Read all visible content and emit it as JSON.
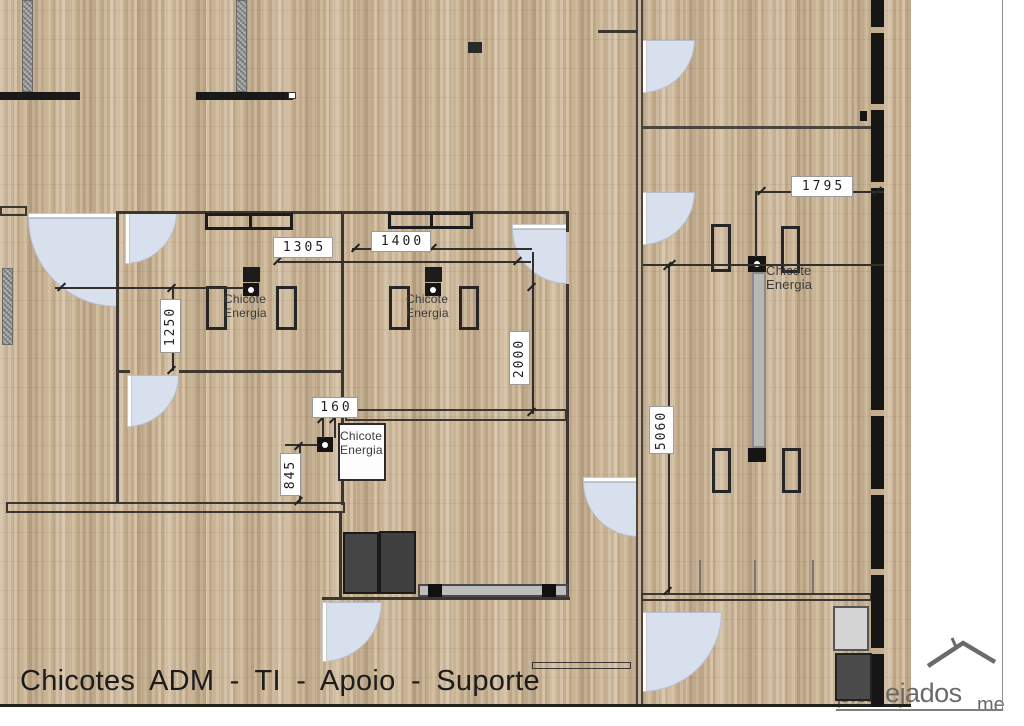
{
  "title": {
    "text": "Chicotes  ADM - TI - Apoio - Suporte"
  },
  "watermark": {
    "text": "planejados",
    "suffix": "me"
  },
  "colors": {
    "floor_base": "#c7b093",
    "wall": "#3b362f",
    "wall_black": "#161616",
    "door_fill": "#d9e0ed",
    "column_gray": "#9c9c9c",
    "dim_text": "#1f1f1f",
    "counter_gray": "#bdbdbd",
    "watermark_gray": "#6a6a6a"
  },
  "plan": {
    "columns": [
      {
        "x": 22,
        "y": 0,
        "w": 11,
        "h": 92
      },
      {
        "x": 236,
        "y": 0,
        "w": 11,
        "h": 92
      },
      {
        "x": 2,
        "y": 268,
        "w": 11,
        "h": 77
      }
    ],
    "doors": [
      {
        "x": 28,
        "y": 218,
        "r": 89,
        "corner": "tr",
        "leaf": "top",
        "n": "door-hall"
      },
      {
        "x": 125,
        "y": 212,
        "r": 52,
        "corner": "tl",
        "leaf": "left",
        "n": "door-room1"
      },
      {
        "x": 127,
        "y": 375,
        "r": 52,
        "corner": "tl",
        "leaf": "left",
        "n": "door-room1-south"
      },
      {
        "x": 512,
        "y": 229,
        "r": 55,
        "corner": "tr",
        "leaf": "top",
        "n": "door-room2"
      },
      {
        "x": 583,
        "y": 482,
        "r": 55,
        "corner": "tr",
        "leaf": "top",
        "n": "door-corridor"
      },
      {
        "x": 642,
        "y": 40,
        "r": 53,
        "corner": "tl",
        "leaf": "left",
        "n": "door-right-top"
      },
      {
        "x": 642,
        "y": 192,
        "r": 53,
        "corner": "tl",
        "leaf": "left",
        "n": "door-right-mid"
      },
      {
        "x": 642,
        "y": 612,
        "r": 80,
        "corner": "tl",
        "leaf": "left",
        "n": "door-right-low"
      },
      {
        "x": 322,
        "y": 602,
        "r": 60,
        "corner": "tl",
        "leaf": "left",
        "n": "door-storage"
      }
    ],
    "walls": [
      {
        "x": 0,
        "y": 92,
        "w": 80,
        "h": 8,
        "c": "#191919",
        "n": "wall-bar-top-left"
      },
      {
        "x": 196,
        "y": 92,
        "w": 97,
        "h": 8,
        "c": "#191919",
        "n": "wall-bar-top-mid"
      },
      {
        "x": 117,
        "y": 211,
        "w": 450,
        "h": 3,
        "n": "wall-rooms-top"
      },
      {
        "x": 116,
        "y": 211,
        "w": 3,
        "h": 292,
        "n": "wall-room1-left"
      },
      {
        "x": 341,
        "y": 211,
        "w": 3,
        "h": 294,
        "n": "wall-room-divider"
      },
      {
        "x": 566,
        "y": 211,
        "w": 3,
        "h": 21,
        "n": "wall-room2-right-a"
      },
      {
        "x": 566,
        "y": 284,
        "w": 3,
        "h": 316,
        "n": "wall-room2-right-b"
      },
      {
        "x": 116,
        "y": 370,
        "w": 14,
        "h": 3,
        "n": "wall-room1-bottom-a"
      },
      {
        "x": 179,
        "y": 370,
        "w": 164,
        "h": 3,
        "n": "wall-room1-bottom-b"
      },
      {
        "x": 339,
        "y": 513,
        "w": 3,
        "h": 87,
        "n": "wall-storage-left"
      },
      {
        "x": 322,
        "y": 597,
        "w": 248,
        "h": 3,
        "n": "wall-storage-bottom"
      },
      {
        "x": 636,
        "y": 0,
        "w": 2,
        "h": 707,
        "c": "#4a453e",
        "n": "wall-divider-line-a"
      },
      {
        "x": 641,
        "y": 0,
        "w": 2,
        "h": 707,
        "c": "#4a453e",
        "n": "wall-divider-line-b"
      },
      {
        "x": 598,
        "y": 30,
        "w": 40,
        "h": 3,
        "n": "wall-top-stub"
      },
      {
        "x": 641,
        "y": 126,
        "w": 231,
        "h": 3,
        "c": "#4a453e",
        "n": "wall-right-corridor"
      },
      {
        "x": 699,
        "y": 560,
        "w": 2,
        "h": 34,
        "c": "#777777",
        "n": "window-mullion"
      },
      {
        "x": 754,
        "y": 560,
        "w": 2,
        "h": 34,
        "c": "#777777",
        "n": "window-mullion"
      },
      {
        "x": 812,
        "y": 560,
        "w": 2,
        "h": 34,
        "c": "#777777",
        "n": "window-mullion"
      },
      {
        "x": 0,
        "y": 704,
        "w": 911,
        "h": 3,
        "c": "#23201c",
        "n": "floor-bottom-edge"
      },
      {
        "x": 1002,
        "y": 0,
        "w": 1,
        "h": 711,
        "c": "#8f8f8f",
        "n": "page-border-right"
      },
      {
        "x": 836,
        "y": 709,
        "w": 167,
        "h": 2,
        "c": "#7d7d7d",
        "n": "watermark-underline"
      }
    ],
    "outlines": [
      {
        "x": 0,
        "y": 206,
        "w": 27,
        "h": 10,
        "b": 2,
        "n": "wall-stub-left"
      },
      {
        "x": 345,
        "y": 409,
        "w": 222,
        "h": 12,
        "b": 2,
        "n": "wall-mid-double"
      },
      {
        "x": 6,
        "y": 502,
        "w": 339,
        "h": 11,
        "b": 2,
        "n": "wall-left-double"
      },
      {
        "x": 641,
        "y": 593,
        "w": 231,
        "h": 8,
        "b": 2,
        "n": "wall-right-bottom"
      },
      {
        "x": 532,
        "y": 662,
        "w": 99,
        "h": 7,
        "b": 1.5,
        "n": "counter-low"
      },
      {
        "x": 288,
        "y": 92,
        "w": 8,
        "h": 7,
        "b": 1,
        "bg": "#ffffff",
        "n": "wall-cap"
      }
    ],
    "black_wall": {
      "x": 871,
      "y": 0,
      "w": 13,
      "h": 707,
      "gaps": [
        27,
        104,
        182,
        410,
        489,
        569,
        648
      ]
    },
    "desks": [
      {
        "x": 206,
        "y": 286,
        "w": 21,
        "h": 44
      },
      {
        "x": 276,
        "y": 286,
        "w": 21,
        "h": 44
      },
      {
        "x": 389,
        "y": 286,
        "w": 21,
        "h": 44
      },
      {
        "x": 459,
        "y": 286,
        "w": 20,
        "h": 44
      },
      {
        "x": 711,
        "y": 224,
        "w": 20,
        "h": 48
      },
      {
        "x": 781,
        "y": 226,
        "w": 19,
        "h": 47
      },
      {
        "x": 712,
        "y": 448,
        "w": 19,
        "h": 45
      },
      {
        "x": 782,
        "y": 448,
        "w": 19,
        "h": 45
      }
    ],
    "cabinets": [
      {
        "x": 205,
        "y": 213,
        "w": 88,
        "h": 17,
        "div": 44
      },
      {
        "x": 388,
        "y": 212,
        "w": 85,
        "h": 17,
        "div": 42
      }
    ],
    "boxes": [
      {
        "x": 343,
        "y": 532,
        "w": 36,
        "h": 62,
        "bg": "#454545",
        "bd": "#1a1a1a",
        "n": "wardrobe"
      },
      {
        "x": 379,
        "y": 531,
        "w": 37,
        "h": 63,
        "bg": "#404040",
        "bd": "#1a1a1a",
        "n": "wardrobe"
      },
      {
        "x": 418,
        "y": 584,
        "w": 150,
        "h": 13,
        "bg": "#bdbdbd",
        "bd": "#4a4a4a",
        "n": "counter"
      },
      {
        "x": 428,
        "y": 584,
        "w": 14,
        "h": 13,
        "bg": "#111111",
        "bd": "#111111",
        "n": "counter-outlet"
      },
      {
        "x": 542,
        "y": 584,
        "w": 14,
        "h": 13,
        "bg": "#111111",
        "bd": "#111111",
        "n": "counter-outlet"
      },
      {
        "x": 752,
        "y": 272,
        "w": 14,
        "h": 176,
        "bg": "#b7b7b7",
        "bd": "#8a8a8a",
        "n": "cable-tray"
      },
      {
        "x": 748,
        "y": 448,
        "w": 18,
        "h": 14,
        "bg": "#151515",
        "bd": "#151515",
        "n": "tray-endcap"
      },
      {
        "x": 833,
        "y": 606,
        "w": 36,
        "h": 45,
        "bg": "#d4d4d4",
        "bd": "#555555",
        "n": "appliance"
      },
      {
        "x": 835,
        "y": 653,
        "w": 37,
        "h": 48,
        "bg": "#4b4b4b",
        "bd": "#222222",
        "n": "cabinet-dark"
      },
      {
        "x": 468,
        "y": 42,
        "w": 14,
        "h": 11,
        "bg": "#2a2a2a",
        "bd": "#2a2a2a",
        "n": "floor-marker"
      },
      {
        "x": 860,
        "y": 111,
        "w": 7,
        "h": 10,
        "bg": "#141414",
        "bd": "#141414",
        "n": "wall-marker"
      },
      {
        "x": 243,
        "y": 267,
        "w": 17,
        "h": 15,
        "bg": "#1c1c1c",
        "bd": "#1c1c1c",
        "n": "junction-box"
      },
      {
        "x": 425,
        "y": 267,
        "w": 17,
        "h": 15,
        "bg": "#1c1c1c",
        "bd": "#1c1c1c",
        "n": "junction-box"
      },
      {
        "x": 338,
        "y": 423,
        "w": 48,
        "h": 58,
        "bg": "#fdfdfd",
        "bd": "#2b2b2b",
        "n": "power-cabinet"
      }
    ],
    "outlets": [
      {
        "x": 243,
        "y": 283,
        "w": 16,
        "h": 13
      },
      {
        "x": 425,
        "y": 283,
        "w": 16,
        "h": 13
      },
      {
        "x": 317,
        "y": 437,
        "w": 16,
        "h": 15
      },
      {
        "x": 748,
        "y": 256,
        "w": 18,
        "h": 16
      }
    ],
    "dim_lines": [
      {
        "x": 278,
        "y": 261,
        "len": 253,
        "o": "h"
      },
      {
        "x": 352,
        "y": 248,
        "len": 180,
        "o": "h"
      },
      {
        "x": 55,
        "y": 287,
        "len": 189,
        "o": "h"
      },
      {
        "x": 172,
        "y": 287,
        "len": 84,
        "o": "v"
      },
      {
        "x": 532,
        "y": 252,
        "len": 162,
        "o": "v"
      },
      {
        "x": 299,
        "y": 444,
        "len": 59,
        "o": "v"
      },
      {
        "x": 285,
        "y": 444,
        "len": 33,
        "o": "h"
      },
      {
        "x": 668,
        "y": 264,
        "len": 329,
        "o": "v"
      },
      {
        "x": 643,
        "y": 264,
        "len": 241,
        "o": "h"
      },
      {
        "x": 755,
        "y": 191,
        "len": 129,
        "o": "h"
      },
      {
        "x": 755,
        "y": 191,
        "len": 66,
        "o": "v"
      },
      {
        "x": 322,
        "y": 416,
        "len": 22,
        "o": "v"
      },
      {
        "x": 334,
        "y": 416,
        "len": 22,
        "o": "v"
      }
    ],
    "ticks": [
      [
        278,
        261
      ],
      [
        518,
        261
      ],
      [
        356,
        248
      ],
      [
        433,
        248
      ],
      [
        62,
        287
      ],
      [
        172,
        288
      ],
      [
        172,
        370
      ],
      [
        532,
        287
      ],
      [
        532,
        412
      ],
      [
        299,
        446
      ],
      [
        299,
        501
      ],
      [
        668,
        266
      ],
      [
        668,
        591
      ],
      [
        762,
        191
      ],
      [
        878,
        191
      ],
      [
        322,
        419
      ],
      [
        334,
        419
      ],
      [
        672,
        264
      ]
    ],
    "dim_labels": [
      {
        "text": "1305",
        "x": 273,
        "y": 237,
        "w": 60,
        "h": 21
      },
      {
        "text": "1400",
        "x": 371,
        "y": 231,
        "w": 60,
        "h": 21
      },
      {
        "text": "1795",
        "x": 791,
        "y": 176,
        "w": 62,
        "h": 21
      },
      {
        "text": "160",
        "x": 312,
        "y": 397,
        "w": 46,
        "h": 21
      },
      {
        "text": "1250",
        "x": 160,
        "y": 299,
        "w": 21,
        "h": 54,
        "vert": true
      },
      {
        "text": "2000",
        "x": 509,
        "y": 331,
        "w": 21,
        "h": 54,
        "vert": true
      },
      {
        "text": "845",
        "x": 280,
        "y": 453,
        "w": 21,
        "h": 43,
        "vert": true
      },
      {
        "text": "5060",
        "x": 649,
        "y": 406,
        "w": 25,
        "h": 48,
        "vert": true
      }
    ],
    "power_labels": [
      {
        "x": 224,
        "y": 292,
        "fs": 12,
        "lines": [
          "Chicote",
          "Energia"
        ]
      },
      {
        "x": 406,
        "y": 292,
        "fs": 12,
        "lines": [
          "Chicote",
          "Energia"
        ]
      },
      {
        "x": 766,
        "y": 264,
        "fs": 13,
        "lines": [
          "Chicote",
          "Energia"
        ]
      },
      {
        "x": 340,
        "y": 429,
        "fs": 12,
        "lines": [
          "Chicote",
          "Energia"
        ]
      }
    ]
  }
}
